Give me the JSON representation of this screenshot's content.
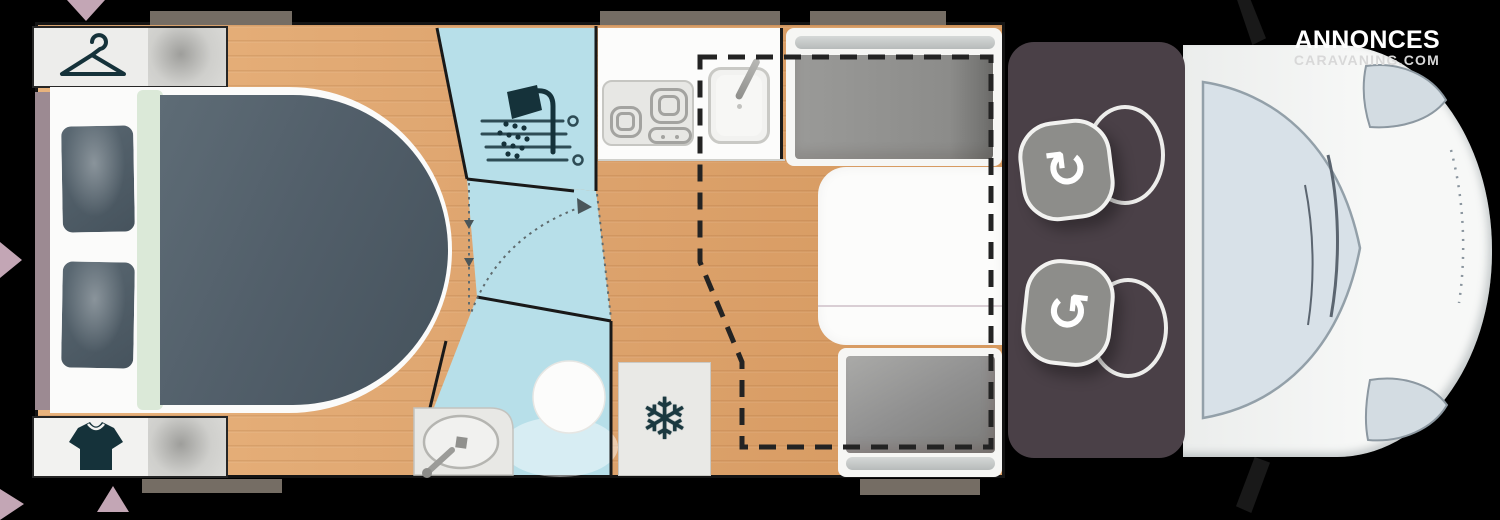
{
  "watermark": {
    "line1": "ANNONCES",
    "line2": "CARAVANING.COM"
  },
  "glyphs": {
    "snowflake": "❄",
    "rotate_clockwise": "↻",
    "rotate_counterclockwise": "↺"
  },
  "icons": [
    "hanger-icon",
    "tshirt-icon",
    "shower-head-icon",
    "snowflake-icon",
    "rotate-cw-icon",
    "rotate-ccw-icon",
    "window-marker-arrow"
  ],
  "colors": {
    "background": "#000000",
    "wood_floor": "#dfa671",
    "bathroom_blue": "#b7dfe9",
    "bed_duvet": "#52606b",
    "bed_band_green": "#dbe9d8",
    "cab_floor": "#4a4047",
    "seat_cushion": "#8d8d8a",
    "vehicle_body": "#f4f5f4",
    "windshield": "#d8e1e8",
    "window_bar_gray": "#756d64",
    "marker_triangle_pink": "#c3a6b5",
    "icon_dark_teal": "#15323a",
    "wall_black": "#141414"
  }
}
